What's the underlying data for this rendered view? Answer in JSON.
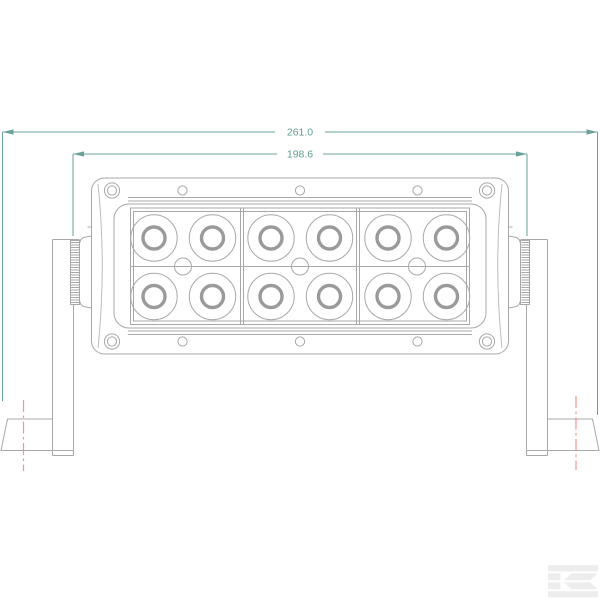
{
  "dimensions": {
    "overall_width": {
      "value": "261.0"
    },
    "mounting_width": {
      "value": "198.6"
    }
  },
  "drawing": {
    "led_rows": 2,
    "led_columns": 6,
    "led_sections": 3,
    "colors": {
      "outline": "#a8a8a8",
      "dimension": "#6aa29b",
      "centerline": "#f2948e",
      "logo": "#ededed",
      "background": "#ffffff"
    }
  },
  "branding": {
    "logo_icon": "kramp-k-logo"
  }
}
